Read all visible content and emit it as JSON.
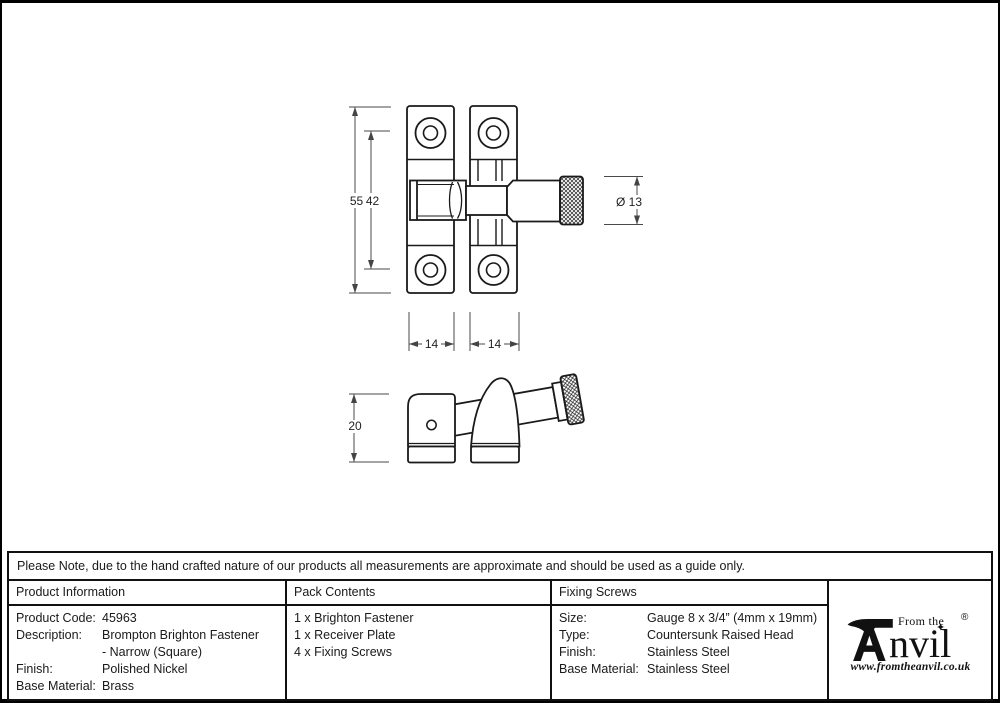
{
  "note": "Please Note, due to the hand crafted nature of our products all measurements are approximate and should be used as a guide only.",
  "drawing": {
    "front_view": {
      "dim_total_height": "55",
      "dim_hole_spacing": "42",
      "dim_knob_diameter": "Ø 13",
      "dim_plate_width_left": "14",
      "dim_plate_width_right": "14"
    },
    "side_view": {
      "dim_height": "20"
    }
  },
  "table": {
    "product_information": {
      "header": "Product Information",
      "rows": [
        {
          "label": "Product Code:",
          "value": "45963"
        },
        {
          "label": "Description:",
          "value": "Brompton Brighton Fastener"
        },
        {
          "label": "",
          "value": "- Narrow (Square)"
        },
        {
          "label": "Finish:",
          "value": "Polished Nickel"
        },
        {
          "label": "Base Material:",
          "value": "Brass"
        }
      ]
    },
    "pack_contents": {
      "header": "Pack Contents",
      "items": [
        "1 x Brighton Fastener",
        "1 x Receiver Plate",
        "4 x Fixing Screws"
      ]
    },
    "fixing_screws": {
      "header": "Fixing Screws",
      "rows": [
        {
          "label": "Size:",
          "value": "Gauge 8 x 3/4” (4mm x 19mm)"
        },
        {
          "label": "Type:",
          "value": "Countersunk Raised Head"
        },
        {
          "label": "Finish:",
          "value": "Stainless Steel"
        },
        {
          "label": "Base Material:",
          "value": "Stainless Steel"
        }
      ]
    }
  },
  "logo": {
    "tagline": "From the",
    "brand_suffix": "nvil",
    "registered": "®",
    "star": "✦",
    "website": "www.fromtheanvil.co.uk"
  }
}
